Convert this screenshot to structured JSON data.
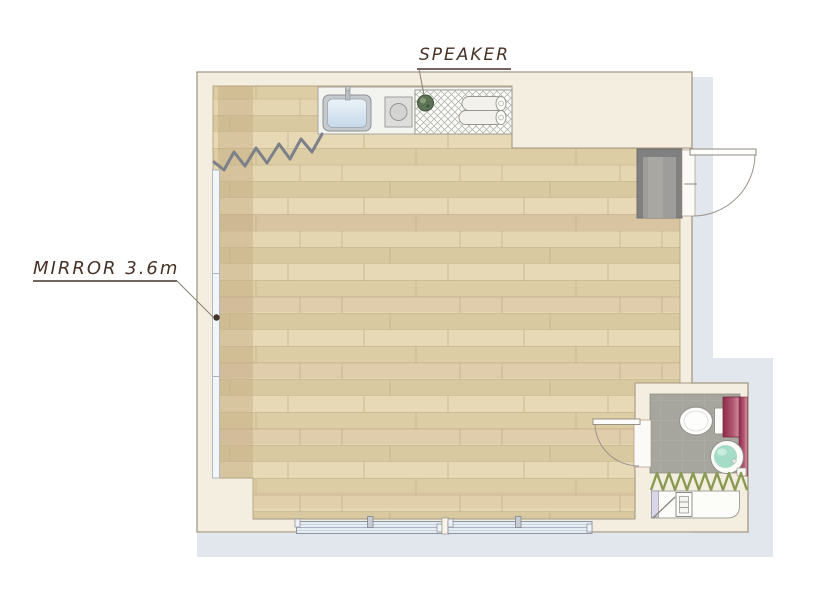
{
  "plan": {
    "labels": {
      "speaker": "SPEAKER",
      "mirror": "MIRROR 3.6m"
    },
    "rooms": [
      "studio-room",
      "bathroom",
      "entry"
    ],
    "fixtures": [
      "kitchen-sink",
      "stove",
      "speaker",
      "rolled-mats",
      "storage-hatch",
      "wall-mirror",
      "audio-cable",
      "entry-mat",
      "entry-door",
      "bathroom-door",
      "toilet",
      "vanity-cabinet",
      "washbasin",
      "shower-curtain",
      "shower-tray",
      "drawer-unit",
      "sliding-window-left",
      "sliding-window-right"
    ],
    "colors": {
      "wall_fill": "#f4eee1",
      "wall_outline": "#a59884",
      "floor_wood": "#e3d4ae",
      "shadow": "#e2e6ed",
      "mirror": "#f2f6f9",
      "speaker_green": "#5d7355",
      "vanity_magenta": "#8e2d4a",
      "basin_water": "#a4dcc8",
      "curtain_green": "#8a9a52",
      "window_glass": "#e4ecf4",
      "label_text": "#483226"
    }
  }
}
